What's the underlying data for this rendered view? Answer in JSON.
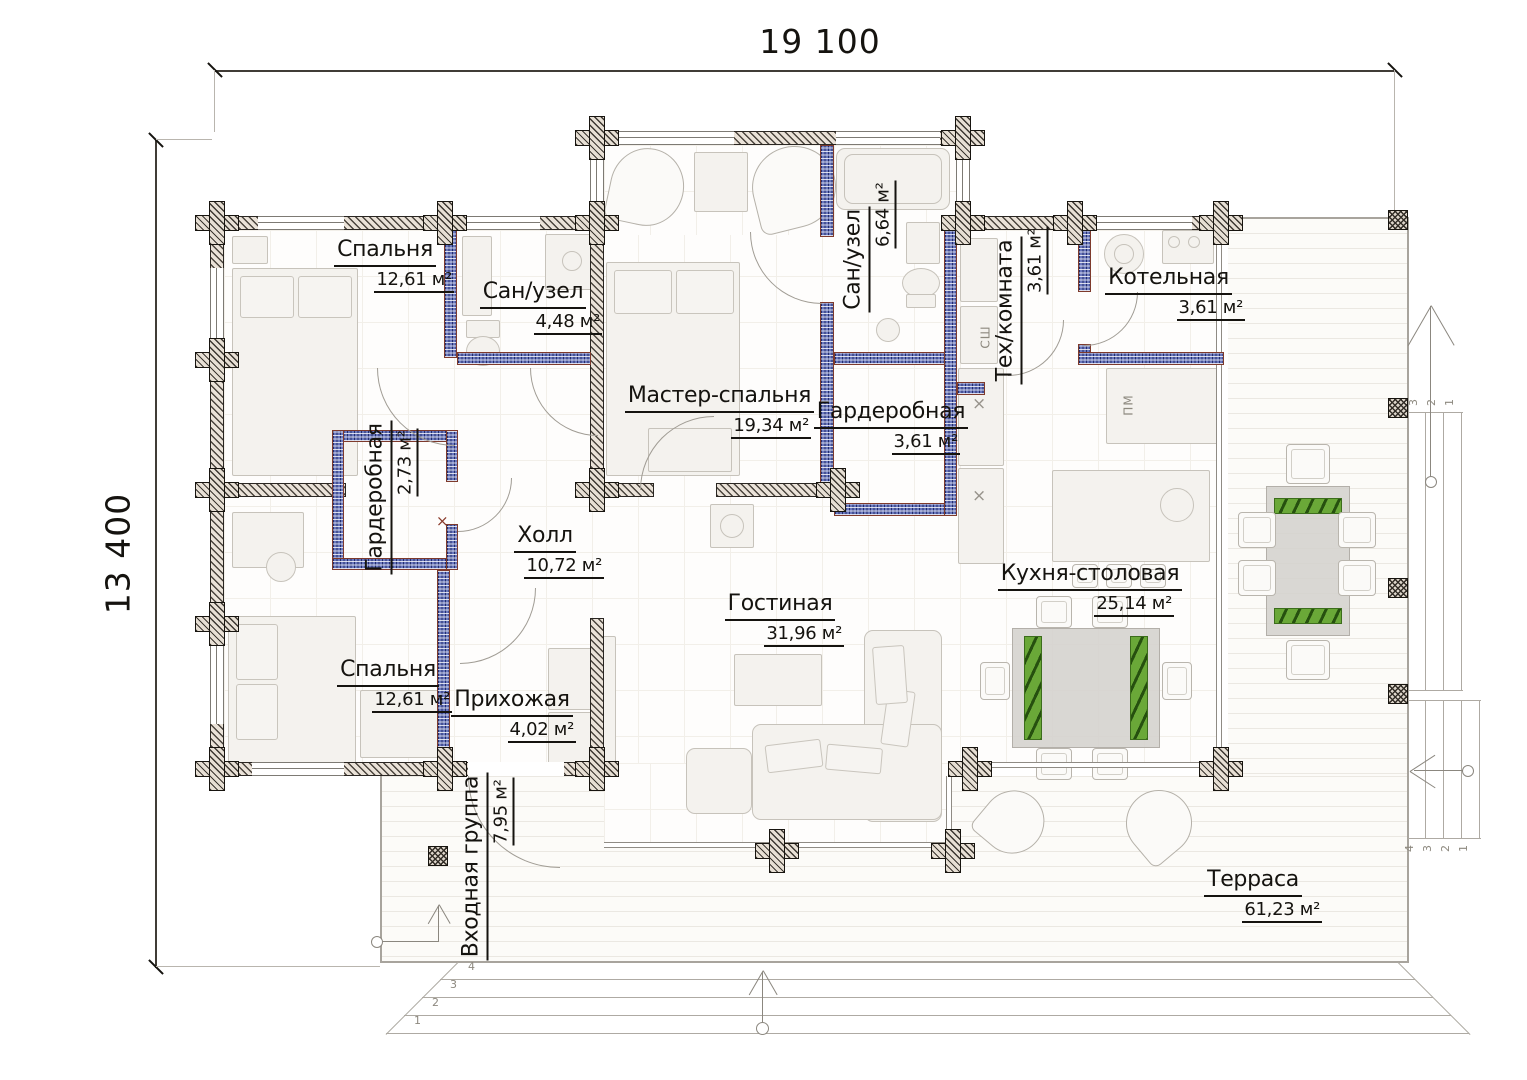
{
  "dimensions": {
    "width_label": "19 100",
    "height_label": "13 400"
  },
  "rooms": [
    {
      "name": "Спальня",
      "area": "12,61 м²"
    },
    {
      "name": "Сан/узел",
      "area": "4,48 м²"
    },
    {
      "name": "Мастер-спальня",
      "area": "19,34 м²"
    },
    {
      "name": "Сан/узел",
      "area": "6,64 м²"
    },
    {
      "name": "Тех/комната",
      "area": "3,61 м²"
    },
    {
      "name": "Котельная",
      "area": "3,61 м²"
    },
    {
      "name": "Гардеробная",
      "area": "3,61 м²"
    },
    {
      "name": "Гардеробная",
      "area": "2,73 м²"
    },
    {
      "name": "Холл",
      "area": "10,72 м²"
    },
    {
      "name": "Гостиная",
      "area": "31,96 м²"
    },
    {
      "name": "Кухня-столовая",
      "area": "25,14 м²"
    },
    {
      "name": "Спальня",
      "area": "12,61 м²"
    },
    {
      "name": "Прихожая",
      "area": "4,02 м²"
    },
    {
      "name": "Входная группа",
      "area": "7,95 м²"
    },
    {
      "name": "Терраса",
      "area": "61,23 м²"
    }
  ],
  "appliance_labels": {
    "drying_cabinet": "СШ",
    "dishwasher": "ПМ"
  },
  "marks": {
    "cross": "×"
  },
  "steps": {
    "bottom": [
      "1",
      "2",
      "3",
      "4"
    ],
    "right_upper": [
      "3",
      "2",
      "1"
    ],
    "right_lower": [
      "4",
      "3",
      "2",
      "1"
    ]
  }
}
